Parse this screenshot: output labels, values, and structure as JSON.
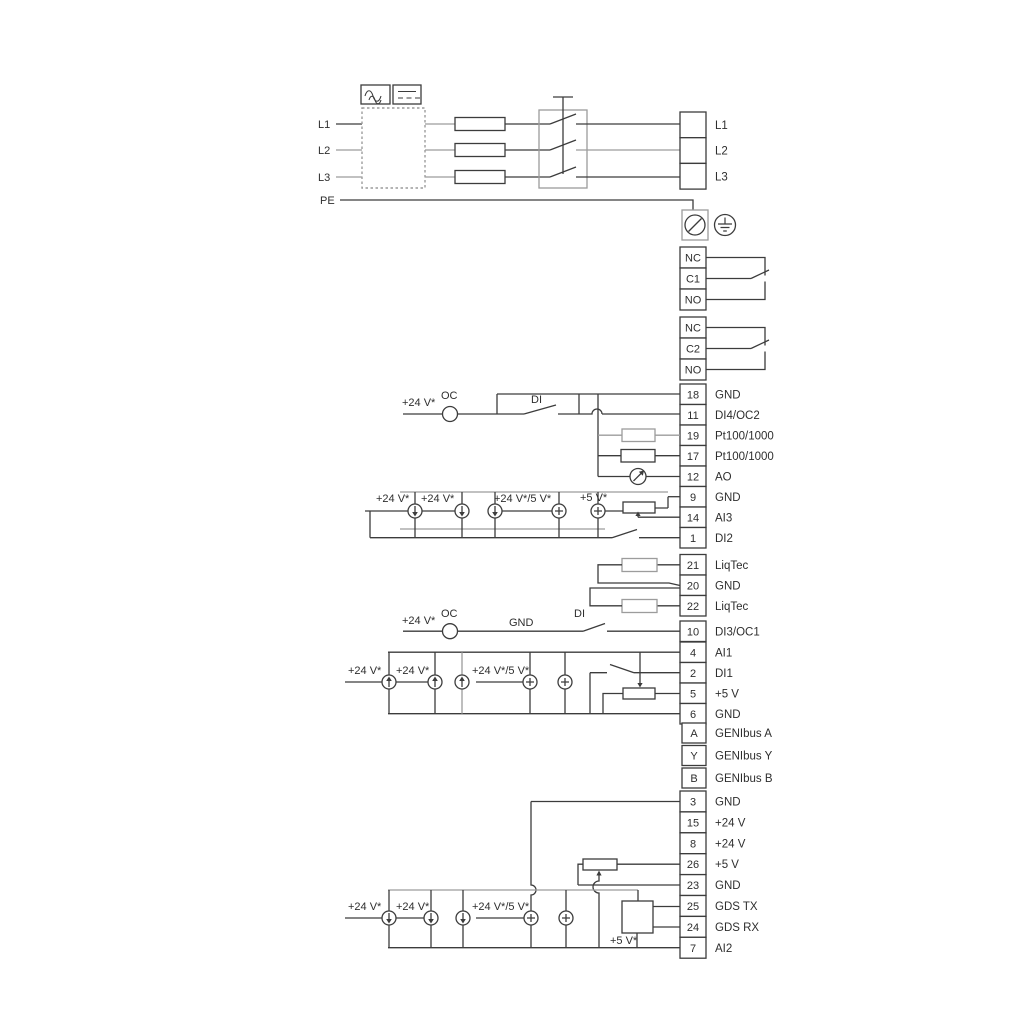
{
  "power": {
    "inputs": [
      "L1",
      "L2",
      "L3",
      "PE"
    ],
    "outputs": [
      "L1",
      "L2",
      "L3"
    ]
  },
  "strips": {
    "lblock": [
      {
        "num": "",
        "label": "L1"
      },
      {
        "num": "",
        "label": "L2"
      },
      {
        "num": "",
        "label": "L3"
      }
    ],
    "relay1": [
      {
        "num": "NC",
        "label": ""
      },
      {
        "num": "C1",
        "label": ""
      },
      {
        "num": "NO",
        "label": ""
      }
    ],
    "relay2": [
      {
        "num": "NC",
        "label": ""
      },
      {
        "num": "C2",
        "label": ""
      },
      {
        "num": "NO",
        "label": ""
      }
    ],
    "io1": [
      {
        "num": "18",
        "label": "GND"
      },
      {
        "num": "11",
        "label": "DI4/OC2"
      },
      {
        "num": "19",
        "label": "Pt100/1000"
      },
      {
        "num": "17",
        "label": "Pt100/1000"
      },
      {
        "num": "12",
        "label": "AO"
      },
      {
        "num": "9",
        "label": "GND"
      },
      {
        "num": "14",
        "label": "AI3"
      },
      {
        "num": "1",
        "label": "DI2"
      }
    ],
    "liqtec": [
      {
        "num": "21",
        "label": "LiqTec"
      },
      {
        "num": "20",
        "label": "GND"
      },
      {
        "num": "22",
        "label": "LiqTec"
      }
    ],
    "di3": [
      {
        "num": "10",
        "label": "DI3/OC1"
      }
    ],
    "io2": [
      {
        "num": "4",
        "label": "AI1"
      },
      {
        "num": "2",
        "label": "DI1"
      },
      {
        "num": "5",
        "label": "+5 V"
      },
      {
        "num": "6",
        "label": "GND"
      }
    ],
    "genibus": [
      {
        "num": "A",
        "label": "GENIbus A"
      },
      {
        "num": "Y",
        "label": "GENIbus Y"
      },
      {
        "num": "B",
        "label": "GENIbus B"
      }
    ],
    "io3": [
      {
        "num": "3",
        "label": "GND"
      },
      {
        "num": "15",
        "label": "+24 V"
      },
      {
        "num": "8",
        "label": "+24 V"
      },
      {
        "num": "26",
        "label": "+5 V"
      },
      {
        "num": "23",
        "label": "GND"
      },
      {
        "num": "25",
        "label": "GDS TX"
      },
      {
        "num": "24",
        "label": "GDS RX"
      },
      {
        "num": "7",
        "label": "AI2"
      }
    ]
  },
  "annotations": {
    "v24": "+24 V*",
    "v24_5": "+24 V*/5 V*",
    "v5": "+5 V*",
    "oc": "OC",
    "di": "DI",
    "gnd": "GND"
  },
  "colors": {
    "line": "#3c3c3c",
    "gray": "#9c9c9c",
    "background": "#ffffff"
  }
}
